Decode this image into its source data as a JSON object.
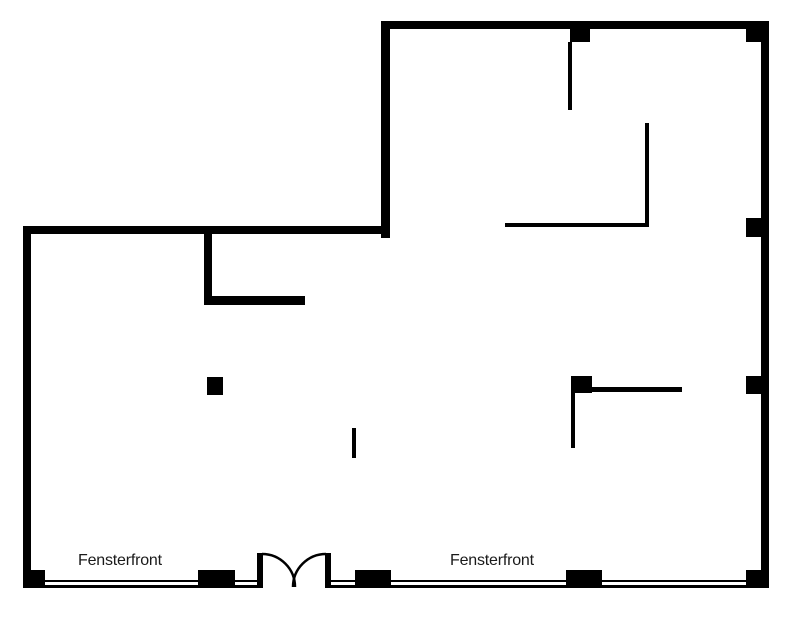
{
  "page": {
    "background": "#ffffff"
  },
  "colors": {
    "wall": "#000000",
    "partition": "#000000",
    "pillar": "#000000",
    "window_line": "#000000",
    "door": "#000000",
    "label_text": "#1a1a1a"
  },
  "labels": {
    "left_window": "Fensterfront",
    "right_window": "Fensterfront"
  },
  "plan": {
    "canvas": {
      "width": 801,
      "height": 620
    },
    "walls": [
      {
        "name": "top-wall",
        "x": 381,
        "y": 21,
        "w": 388,
        "h": 8
      },
      {
        "name": "upper-left-wall",
        "x": 381,
        "y": 21,
        "w": 9,
        "h": 217
      },
      {
        "name": "left-wing-top-wall",
        "x": 23,
        "y": 226,
        "w": 367,
        "h": 8
      },
      {
        "name": "left-wall",
        "x": 23,
        "y": 226,
        "w": 8,
        "h": 362
      },
      {
        "name": "right-wall",
        "x": 761,
        "y": 21,
        "w": 8,
        "h": 567
      },
      {
        "name": "interior-wall-vertical",
        "x": 204,
        "y": 234,
        "w": 8,
        "h": 71
      },
      {
        "name": "interior-wall-horizontal",
        "x": 204,
        "y": 296,
        "w": 101,
        "h": 9
      }
    ],
    "partitions": [
      {
        "name": "partition-top-center",
        "x": 568,
        "y": 42,
        "w": 4,
        "h": 68
      },
      {
        "name": "partition-upper-l-vertical",
        "x": 645,
        "y": 123,
        "w": 4,
        "h": 104
      },
      {
        "name": "partition-upper-l-horizontal",
        "x": 505,
        "y": 223,
        "w": 144,
        "h": 4
      },
      {
        "name": "partition-mid-horizontal",
        "x": 592,
        "y": 387,
        "w": 90,
        "h": 5
      },
      {
        "name": "partition-mid-vertical",
        "x": 571,
        "y": 393,
        "w": 4,
        "h": 55
      },
      {
        "name": "partition-tick",
        "x": 352,
        "y": 428,
        "w": 4,
        "h": 30
      }
    ],
    "pillars": [
      {
        "name": "pillar-bottom-left-corner",
        "x": 23,
        "y": 570,
        "w": 22,
        "h": 18
      },
      {
        "name": "pillar-bottom-1",
        "x": 198,
        "y": 570,
        "w": 37,
        "h": 18
      },
      {
        "name": "pillar-bottom-2",
        "x": 355,
        "y": 570,
        "w": 36,
        "h": 18
      },
      {
        "name": "pillar-bottom-3",
        "x": 566,
        "y": 570,
        "w": 36,
        "h": 18
      },
      {
        "name": "pillar-bottom-right-corner",
        "x": 746,
        "y": 570,
        "w": 23,
        "h": 18
      },
      {
        "name": "pillar-top-center",
        "x": 570,
        "y": 29,
        "w": 20,
        "h": 13
      },
      {
        "name": "pillar-top-right-corner",
        "x": 746,
        "y": 29,
        "w": 15,
        "h": 13
      },
      {
        "name": "pillar-right-wall-upper",
        "x": 746,
        "y": 218,
        "w": 15,
        "h": 19
      },
      {
        "name": "pillar-right-wall-lower",
        "x": 746,
        "y": 376,
        "w": 15,
        "h": 18
      },
      {
        "name": "pillar-freestanding-right",
        "x": 571,
        "y": 376,
        "w": 21,
        "h": 17
      },
      {
        "name": "pillar-freestanding-left",
        "x": 207,
        "y": 377,
        "w": 16,
        "h": 18
      }
    ],
    "window_lines": [
      {
        "name": "window-line-left-outer",
        "x": 31,
        "y": 580,
        "w": 226,
        "h": 2
      },
      {
        "name": "window-line-left-inner",
        "x": 31,
        "y": 585,
        "w": 226,
        "h": 3
      },
      {
        "name": "window-line-right-outer",
        "x": 331,
        "y": 580,
        "w": 430,
        "h": 2
      },
      {
        "name": "window-line-right-inner",
        "x": 331,
        "y": 585,
        "w": 430,
        "h": 3
      }
    ],
    "door": {
      "posts": [
        {
          "name": "door-post-left",
          "x": 257,
          "y": 553,
          "w": 6,
          "h": 35
        },
        {
          "name": "door-post-right",
          "x": 325,
          "y": 553,
          "w": 6,
          "h": 35
        }
      ],
      "arcs": [
        {
          "name": "door-swing-left",
          "d": "M 262 554 A 33 33 0 0 1 295 587"
        },
        {
          "name": "door-swing-right",
          "d": "M 326 554 A 33 33 0 0 0 293 587"
        }
      ],
      "stroke_width": 2.5
    }
  }
}
